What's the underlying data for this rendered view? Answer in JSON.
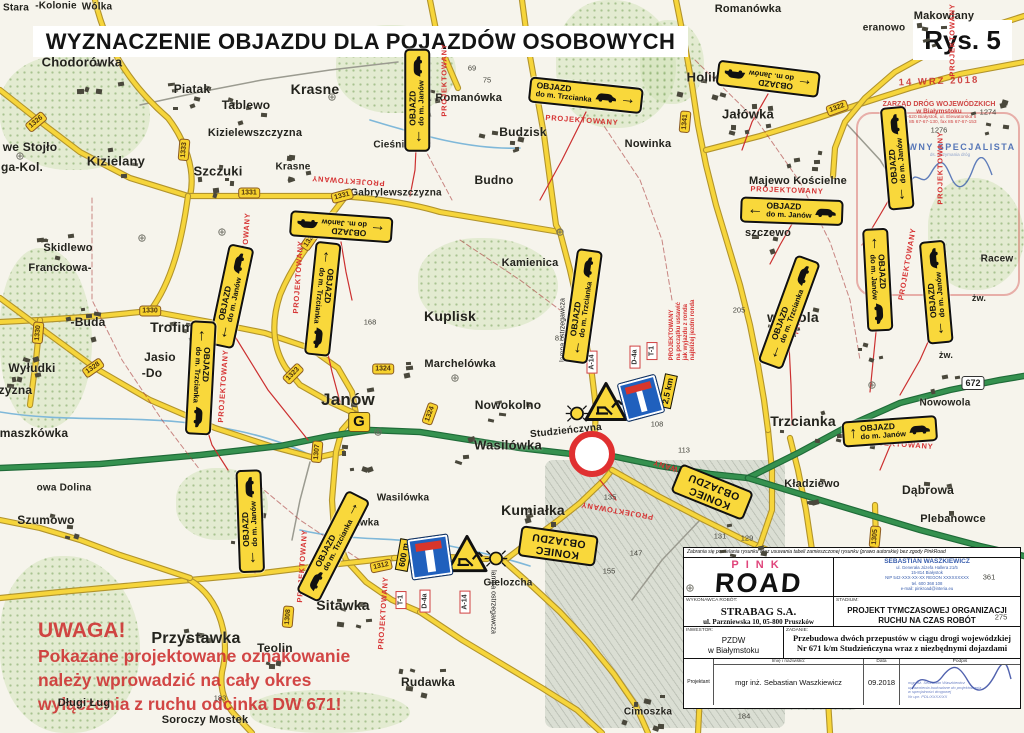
{
  "title": "WYZNACZENIE OBJAZDU DLA POJAZDÓW OSOBOWYCH",
  "figure_label": "Rys. 5",
  "warning": {
    "lines": [
      "UWAGA!",
      "Pokazane projektowane oznakowanie",
      "należy wprowadzić na cały okres",
      "wyłączenia z ruchu odcinka DW 671!"
    ]
  },
  "stamps": {
    "date": "14 WRZ 2018",
    "zdw": [
      "ZARZĄD DRÓG WOJEWÓDZKICH",
      "w Białymstoku",
      "15-620 Białystok, ul. Elewatorska 6",
      "tel. 85 67-67-130, fax 85 67-67-153"
    ],
    "specialist": "GŁÓWNY SPECJALISTA",
    "specialist_sub": "ds. utrzymania dróg"
  },
  "title_block": {
    "disclaimer": "Zabrania się powielania rysunku oraz usuwania tabeli zamieszczonej rysunku (prawo autorskie) bez zgody PinkRoad",
    "logo_top": "PINK",
    "logo_main": "ROAD",
    "designer_company": "SEBASTIAN WASZKIEWICZ",
    "designer_lines": [
      "ul. Generała Józefa Hallera 21/5",
      "15-814 Białystok",
      "NIP 542-XXX-XX-XX   REGON XXXXXXXXX",
      "tel. 600 368 108",
      "e-mail: pinkroad@interia.eu"
    ],
    "contractor_label": "WYKONAWCA ROBÓT:",
    "contractor_name": "STRABAG S.A.",
    "contractor_addr": "ul. Parzniewska 10, 05-800 Pruszków",
    "stage_label": "STADIUM:",
    "stage_value": "PROJEKT TYMCZASOWEJ ORGANIZACJI RUCHU NA CZAS ROBÓT",
    "investor_label": "INWESTOR:",
    "investor_line1": "PZDW",
    "investor_line2": "w Białymstoku",
    "task_label": "ZADANIE:",
    "task_value": "Przebudowa dwóch przepustów w ciągu drogi wojewódzkiej Nr 671 k/m Studzieńczyna wraz z niezbędnymi dojazdami",
    "col_name": "Imię i nazwisko:",
    "col_date": "Data",
    "col_sign": "Podpis",
    "role": "Projektant",
    "designer_name": "mgr inż. Sebastian Waszkiewicz",
    "date": "09.2018",
    "sig_stamp_lines": [
      "mgr inż. Sebastian Waszkiewicz",
      "uprawnienia budowlane do projektowania",
      "w specjalności drogowej",
      "Nr upr. PDL/XXXX/XX"
    ]
  },
  "map": {
    "colors": {
      "road_yellow": "#f6d53b",
      "road_green": "#35914f",
      "detour_red": "#cc3030",
      "sign_yellow": "#f9d83b",
      "sign_blue": "#2060bd"
    },
    "sign_title": "OBJAZD",
    "koniec_lines": [
      "KONIEC",
      "OBJAZDU"
    ],
    "places": [
      {
        "t": "Stara",
        "x": 16,
        "y": 8,
        "fs": 10
      },
      {
        "t": "-Kolonie",
        "x": 56,
        "y": 6,
        "fs": 10
      },
      {
        "t": "Wólka",
        "x": 97,
        "y": 7,
        "fs": 10
      },
      {
        "t": "Chodorówka",
        "x": 82,
        "y": 62,
        "fs": 13
      },
      {
        "t": "Piatak",
        "x": 192,
        "y": 89,
        "fs": 12
      },
      {
        "t": "Tablewo",
        "x": 246,
        "y": 105,
        "fs": 12
      },
      {
        "t": "Krasne",
        "x": 315,
        "y": 89,
        "fs": 14
      },
      {
        "t": "Kizielewszczyzna",
        "x": 255,
        "y": 133,
        "fs": 11
      },
      {
        "t": "we Stojło",
        "x": 30,
        "y": 147,
        "fs": 12
      },
      {
        "t": "ga-Kol.",
        "x": 22,
        "y": 167,
        "fs": 12
      },
      {
        "t": "Kizielany",
        "x": 116,
        "y": 161,
        "fs": 13
      },
      {
        "t": "Szczuki",
        "x": 218,
        "y": 171,
        "fs": 13
      },
      {
        "t": "Krasne",
        "x": 293,
        "y": 167,
        "fs": 10
      },
      {
        "t": "Gabrylewszczyzna",
        "x": 396,
        "y": 193,
        "fs": 10
      },
      {
        "t": "Skidlewo",
        "x": 68,
        "y": 248,
        "fs": 11
      },
      {
        "t": "Franckowa-",
        "x": 60,
        "y": 268,
        "fs": 11
      },
      {
        "t": "-Buda",
        "x": 88,
        "y": 322,
        "fs": 12
      },
      {
        "t": "Trofimówka",
        "x": 190,
        "y": 327,
        "fs": 14
      },
      {
        "t": "Wyłudki",
        "x": 32,
        "y": 368,
        "fs": 12
      },
      {
        "t": "czyzna",
        "x": 12,
        "y": 390,
        "fs": 12
      },
      {
        "t": "maszkówka",
        "x": 34,
        "y": 433,
        "fs": 12
      },
      {
        "t": "Jasio",
        "x": 160,
        "y": 357,
        "fs": 12
      },
      {
        "t": "-Do",
        "x": 152,
        "y": 373,
        "fs": 12
      },
      {
        "t": "Marchelówka",
        "x": 460,
        "y": 364,
        "fs": 11
      },
      {
        "t": "Janów",
        "x": 348,
        "y": 400,
        "fs": 17
      },
      {
        "t": "Kuplisk",
        "x": 450,
        "y": 316,
        "fs": 14
      },
      {
        "t": "Kamienica",
        "x": 530,
        "y": 263,
        "fs": 11
      },
      {
        "t": "Budno",
        "x": 494,
        "y": 180,
        "fs": 12
      },
      {
        "t": "Budzisk",
        "x": 523,
        "y": 132,
        "fs": 12
      },
      {
        "t": "L. Romanówka",
        "x": 462,
        "y": 98,
        "fs": 11
      },
      {
        "t": "Cieśnisk Mł",
        "x": 402,
        "y": 145,
        "fs": 10
      },
      {
        "t": "Romanówka",
        "x": 748,
        "y": 9,
        "fs": 11
      },
      {
        "t": "eranowo",
        "x": 884,
        "y": 28,
        "fs": 10
      },
      {
        "t": "Makowlany",
        "x": 944,
        "y": 16,
        "fs": 11
      },
      {
        "t": "Holik",
        "x": 703,
        "y": 77,
        "fs": 13
      },
      {
        "t": "Jałówka",
        "x": 748,
        "y": 114,
        "fs": 13
      },
      {
        "t": "Nowinka",
        "x": 648,
        "y": 144,
        "fs": 11
      },
      {
        "t": "Majewo Kościelne",
        "x": 798,
        "y": 181,
        "fs": 11
      },
      {
        "t": "szczewo",
        "x": 768,
        "y": 233,
        "fs": 11
      },
      {
        "t": "wowola",
        "x": 793,
        "y": 317,
        "fs": 14
      },
      {
        "t": "Nowowola",
        "x": 945,
        "y": 403,
        "fs": 10
      },
      {
        "t": "Trzcianka",
        "x": 803,
        "y": 421,
        "fs": 14
      },
      {
        "t": "Racew",
        "x": 997,
        "y": 259,
        "fs": 10
      },
      {
        "t": "żw.",
        "x": 979,
        "y": 298,
        "fs": 9
      },
      {
        "t": "żw.",
        "x": 946,
        "y": 355,
        "fs": 9
      },
      {
        "t": "Kładziewo",
        "x": 812,
        "y": 484,
        "fs": 11
      },
      {
        "t": "Dąbrowa",
        "x": 928,
        "y": 490,
        "fs": 12
      },
      {
        "t": "Plebanowce",
        "x": 953,
        "y": 519,
        "fs": 11
      },
      {
        "t": "Nowokolno",
        "x": 508,
        "y": 405,
        "fs": 12
      },
      {
        "t": "Studzieńczyna",
        "x": 566,
        "y": 431,
        "fs": 10,
        "rot": -6
      },
      {
        "t": "Wasilówka",
        "x": 508,
        "y": 445,
        "fs": 13
      },
      {
        "t": "Wasilówka",
        "x": 403,
        "y": 498,
        "fs": 10
      },
      {
        "t": "Kumiałka",
        "x": 533,
        "y": 510,
        "fs": 14
      },
      {
        "t": "Sitawka",
        "x": 343,
        "y": 605,
        "fs": 14
      },
      {
        "t": "Sitawka",
        "x": 360,
        "y": 523,
        "fs": 10
      },
      {
        "t": "Gielozcha",
        "x": 508,
        "y": 583,
        "fs": 10
      },
      {
        "t": "Teolin",
        "x": 275,
        "y": 648,
        "fs": 12
      },
      {
        "t": "Przystawka",
        "x": 196,
        "y": 639,
        "fs": 16
      },
      {
        "t": "Rudawka",
        "x": 428,
        "y": 682,
        "fs": 12
      },
      {
        "t": "Cimoszka",
        "x": 648,
        "y": 712,
        "fs": 10
      },
      {
        "t": "Soroczy Mostek",
        "x": 205,
        "y": 720,
        "fs": 11
      },
      {
        "t": "Długi Ług",
        "x": 84,
        "y": 703,
        "fs": 11
      },
      {
        "t": "owa Dolina",
        "x": 64,
        "y": 488,
        "fs": 10
      },
      {
        "t": "Szumowo",
        "x": 46,
        "y": 520,
        "fs": 12
      }
    ],
    "numbers": [
      {
        "t": "69",
        "x": 472,
        "y": 68
      },
      {
        "t": "75",
        "x": 487,
        "y": 80
      },
      {
        "t": "81",
        "x": 559,
        "y": 338
      },
      {
        "t": "92",
        "x": 576,
        "y": 286
      },
      {
        "t": "105",
        "x": 579,
        "y": 318
      },
      {
        "t": "108",
        "x": 657,
        "y": 424
      },
      {
        "t": "113",
        "x": 684,
        "y": 450
      },
      {
        "t": "124",
        "x": 669,
        "y": 467
      },
      {
        "t": "135",
        "x": 610,
        "y": 497
      },
      {
        "t": "133",
        "x": 687,
        "y": 483
      },
      {
        "t": "131",
        "x": 720,
        "y": 536
      },
      {
        "t": "129",
        "x": 747,
        "y": 538
      },
      {
        "t": "147",
        "x": 636,
        "y": 553
      },
      {
        "t": "155",
        "x": 609,
        "y": 571
      },
      {
        "t": "168",
        "x": 370,
        "y": 322
      },
      {
        "t": "183",
        "x": 220,
        "y": 698
      },
      {
        "t": "184",
        "x": 744,
        "y": 716
      },
      {
        "t": "205",
        "x": 739,
        "y": 310
      },
      {
        "t": "361",
        "x": 989,
        "y": 577
      },
      {
        "t": "275",
        "x": 1001,
        "y": 617
      },
      {
        "t": "1274",
        "x": 988,
        "y": 112
      },
      {
        "t": "1276",
        "x": 939,
        "y": 130
      }
    ],
    "shields": [
      {
        "t": "1326",
        "x": 36,
        "y": 122,
        "rot": -40
      },
      {
        "t": "1333",
        "x": 184,
        "y": 150,
        "rot": -85
      },
      {
        "t": "1331",
        "x": 249,
        "y": 193,
        "rot": 0
      },
      {
        "t": "1321",
        "x": 310,
        "y": 240,
        "rot": -55
      },
      {
        "t": "1331",
        "x": 342,
        "y": 196,
        "rot": -15
      },
      {
        "t": "1330",
        "x": 150,
        "y": 311,
        "rot": 0
      },
      {
        "t": "1330",
        "x": 38,
        "y": 333,
        "rot": -85
      },
      {
        "t": "1328",
        "x": 93,
        "y": 368,
        "rot": -35
      },
      {
        "t": "1323",
        "x": 293,
        "y": 374,
        "rot": -45
      },
      {
        "t": "1324",
        "x": 383,
        "y": 369,
        "rot": 0
      },
      {
        "t": "1324",
        "x": 430,
        "y": 414,
        "rot": -70
      },
      {
        "t": "1307",
        "x": 317,
        "y": 452,
        "rot": -85
      },
      {
        "t": "1312",
        "x": 381,
        "y": 566,
        "rot": -12
      },
      {
        "t": "1308",
        "x": 288,
        "y": 617,
        "rot": -85
      },
      {
        "t": "1341",
        "x": 685,
        "y": 122,
        "rot": -85
      },
      {
        "t": "1322",
        "x": 837,
        "y": 108,
        "rot": -20
      },
      {
        "t": "1305",
        "x": 875,
        "y": 537,
        "rot": -85
      },
      {
        "t": "672",
        "x": 973,
        "y": 383,
        "rot": 0,
        "style": "white"
      }
    ],
    "detour_signs": [
      {
        "x": 417,
        "y": 100,
        "rot": -90,
        "dest": "do m. Janów",
        "glyph": "←",
        "arrow": "start",
        "car": "end"
      },
      {
        "x": 586,
        "y": 95,
        "rot": 6,
        "dest": "do m. Trzcianka",
        "glyph": "→",
        "arrow": "end",
        "car": "end"
      },
      {
        "x": 768,
        "y": 79,
        "rot": 187,
        "dest": "do m. Janów",
        "glyph": "←",
        "arrow": "start",
        "car": "end"
      },
      {
        "x": 897,
        "y": 158,
        "rot": -95,
        "dest": "do m. Janów",
        "glyph": "←",
        "arrow": "start",
        "car": "end"
      },
      {
        "x": 792,
        "y": 211,
        "rot": 2,
        "dest": "do m. Janów",
        "glyph": "←",
        "arrow": "start",
        "car": "end"
      },
      {
        "x": 341,
        "y": 227,
        "rot": 184,
        "dest": "do m. Janów",
        "glyph": "←",
        "arrow": "start",
        "car": "end"
      },
      {
        "x": 231,
        "y": 296,
        "rot": -78,
        "dest": "do m. Janów",
        "glyph": "←",
        "arrow": "start",
        "car": "end"
      },
      {
        "x": 323,
        "y": 299,
        "rot": 96,
        "dest": "do m. Trzcianka",
        "glyph": "←",
        "arrow": "start",
        "car": "end"
      },
      {
        "x": 201,
        "y": 378,
        "rot": 93,
        "dest": "do m. Trzcianka",
        "glyph": "←",
        "arrow": "start",
        "car": "end"
      },
      {
        "x": 582,
        "y": 306,
        "rot": -82,
        "dest": "do m. Trzcianka",
        "glyph": "←",
        "arrow": "start",
        "car": "end"
      },
      {
        "x": 789,
        "y": 312,
        "rot": -70,
        "dest": "do m. Trzcianka",
        "glyph": "←",
        "arrow": "start",
        "car": "end"
      },
      {
        "x": 878,
        "y": 280,
        "rot": 87,
        "dest": "do m. Janów",
        "glyph": "←",
        "arrow": "start",
        "car": "end"
      },
      {
        "x": 936,
        "y": 292,
        "rot": -95,
        "dest": "do m. Janów",
        "glyph": "←",
        "arrow": "start",
        "car": "end"
      },
      {
        "x": 890,
        "y": 431,
        "rot": -4,
        "dest": "do m. Janów",
        "glyph": "↑",
        "arrow": "start",
        "car": "end"
      },
      {
        "x": 333,
        "y": 546,
        "rot": -63,
        "dest": "do m. Trzcianka",
        "glyph": "→",
        "arrow": "end",
        "car": "start"
      },
      {
        "x": 250,
        "y": 521,
        "rot": -92,
        "dest": "do m. Janów",
        "glyph": "←",
        "arrow": "start",
        "car": "end"
      }
    ],
    "koniec_signs": [
      {
        "x": 558,
        "y": 546,
        "rot": 188
      },
      {
        "x": 712,
        "y": 492,
        "rot": 202
      }
    ],
    "projektowany": "PROJEKTOWANY",
    "projektowany_pos": [
      {
        "x": 444,
        "y": 80,
        "rot": -90
      },
      {
        "x": 582,
        "y": 120,
        "rot": 4
      },
      {
        "x": 952,
        "y": 40,
        "rot": -90
      },
      {
        "x": 940,
        "y": 168,
        "rot": -90
      },
      {
        "x": 787,
        "y": 190,
        "rot": 2
      },
      {
        "x": 348,
        "y": 181,
        "rot": 184
      },
      {
        "x": 245,
        "y": 249,
        "rot": -86
      },
      {
        "x": 298,
        "y": 277,
        "rot": -86
      },
      {
        "x": 223,
        "y": 386,
        "rot": -86
      },
      {
        "x": 802,
        "y": 298,
        "rot": -80
      },
      {
        "x": 907,
        "y": 264,
        "rot": -80
      },
      {
        "x": 897,
        "y": 444,
        "rot": 4
      },
      {
        "x": 617,
        "y": 511,
        "rot": 190
      },
      {
        "x": 688,
        "y": 473,
        "rot": 197
      },
      {
        "x": 302,
        "y": 566,
        "rot": -86
      },
      {
        "x": 383,
        "y": 613,
        "rot": -86
      }
    ],
    "type_labels": [
      {
        "t": "A-14",
        "x": 592,
        "y": 362,
        "rot": -90
      },
      {
        "t": "D-4a",
        "x": 635,
        "y": 357,
        "rot": -90
      },
      {
        "t": "T-1",
        "x": 652,
        "y": 351,
        "rot": -90
      },
      {
        "t": "T-1",
        "x": 401,
        "y": 600,
        "rot": -90
      },
      {
        "t": "D-4a",
        "x": 425,
        "y": 601,
        "rot": -90
      },
      {
        "t": "A-14",
        "x": 465,
        "y": 602,
        "rot": -90
      }
    ],
    "plates": [
      {
        "t": "2,5 km",
        "x": 668,
        "y": 391,
        "rot": -78
      },
      {
        "t": "600 m",
        "x": 404,
        "y": 555,
        "rot": -80
      }
    ],
    "lamp_texts": [
      {
        "t": "lampa ostrzegawcza",
        "x": 563,
        "y": 330,
        "rot": -90
      },
      {
        "t": "lampa ostrzegawcza",
        "x": 493,
        "y": 602,
        "rot": 90
      }
    ],
    "special_note": {
      "x": 683,
      "y": 330,
      "lines": [
        "PROJEKTOWANY",
        "na początku ustawić",
        "jak wyjazdu z ronda",
        "najbliżej jezdni ronda"
      ]
    },
    "g_marker": {
      "t": "G",
      "x": 359,
      "y": 422
    },
    "a14_triangles": [
      {
        "x": 606,
        "y": 404,
        "s": 44
      },
      {
        "x": 467,
        "y": 556,
        "s": 42
      }
    ],
    "d4a_signs": [
      {
        "x": 641,
        "y": 398,
        "s": 38,
        "rot": -15
      },
      {
        "x": 430,
        "y": 557,
        "s": 40,
        "rot": -8
      }
    ],
    "lamps": [
      {
        "x": 577,
        "y": 416
      },
      {
        "x": 496,
        "y": 561
      }
    ],
    "roundabout": {
      "x": 592,
      "y": 454
    }
  }
}
